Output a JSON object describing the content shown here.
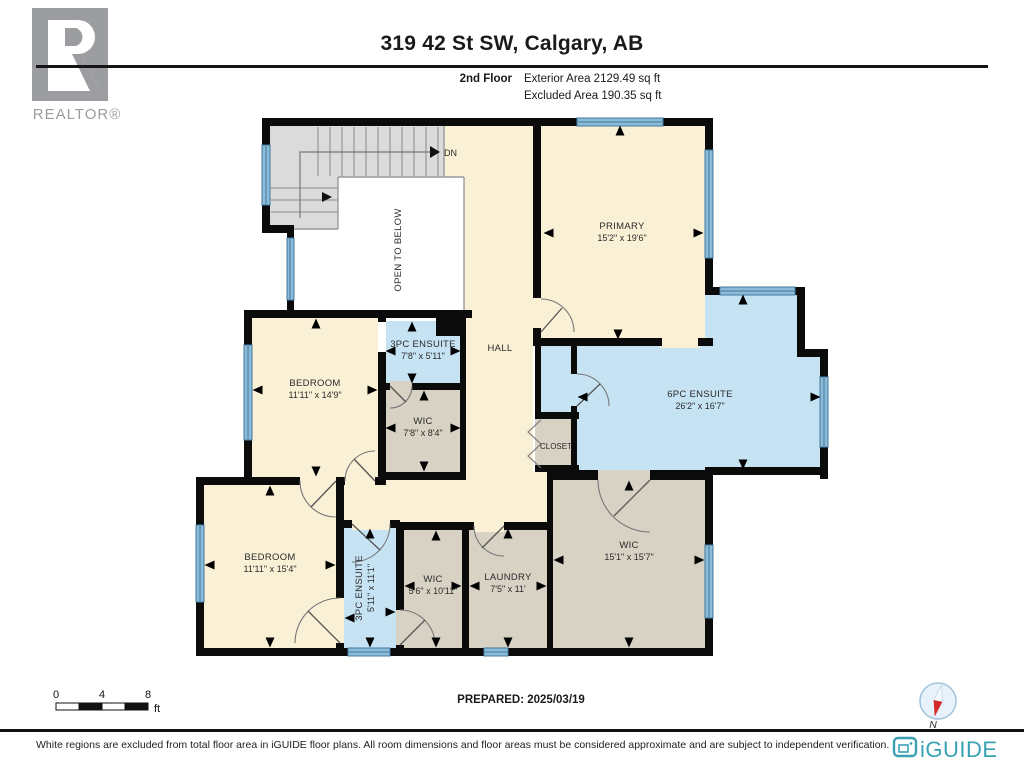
{
  "header": {
    "title": "319 42 St SW, Calgary, AB",
    "floor_label": "2nd Floor",
    "exterior_area": "Exterior Area 2129.49 sq ft",
    "excluded_area": "Excluded Area 190.35 sq ft",
    "realtor_logo_text": "REALTOR®"
  },
  "plan": {
    "labels": {
      "dn": "DN",
      "open_to_below": "OPEN TO BELOW",
      "hall": "HALL",
      "closet": "CLOSET"
    },
    "rooms": {
      "primary": {
        "name": "PRIMARY",
        "dims": "15'2\" x 19'6\""
      },
      "ensuite6": {
        "name": "6PC ENSUITE",
        "dims": "26'2\" x 16'7\""
      },
      "ensuite3_top": {
        "name": "3PC ENSUITE",
        "dims": "7'8\" x 5'11\""
      },
      "wic_mid": {
        "name": "WIC",
        "dims": "7'8\" x 8'4\""
      },
      "bedroom_mid": {
        "name": "BEDROOM",
        "dims": "11'11\" x 14'9\""
      },
      "bedroom_btm": {
        "name": "BEDROOM",
        "dims": "11'11\" x 15'4\""
      },
      "ensuite3_btm": {
        "name": "3PC ENSUITE",
        "dims": "5'11\" x 11'1\""
      },
      "wic_small": {
        "name": "WIC",
        "dims": "5'6\" x 10'11\""
      },
      "laundry": {
        "name": "LAUNDRY",
        "dims": "7'5\" x 11'"
      },
      "wic_big": {
        "name": "WIC",
        "dims": "15'1\" x 15'7\""
      }
    }
  },
  "footer": {
    "scale": {
      "t0": "0",
      "t4": "4",
      "t8": "8",
      "unit": "ft"
    },
    "prepared": "PREPARED: 2025/03/19",
    "compass_n": "N",
    "disclaimer": "White regions are excluded from total floor area in iGUIDE floor plans. All room dimensions and floor areas must be considered approximate and are subject to independent verification.",
    "brand": "iGUIDE"
  },
  "colors": {
    "floor_cream": "#FAF0D5",
    "bathroom_blue": "#C6E3F4",
    "closet_tan": "#D8D2C4",
    "stairs_gray": "#DBDBDB",
    "window_blue": "#8CBBD8",
    "wall_black": "#0b0b0b",
    "brand_teal": "#3AA1B5",
    "realtor_gray": "#9C9DA1"
  }
}
